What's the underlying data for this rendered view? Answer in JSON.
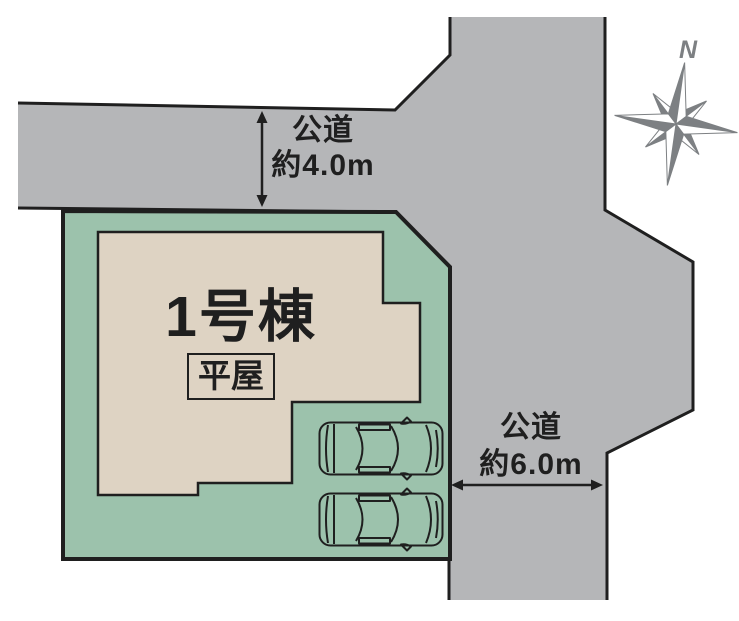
{
  "canvas": {
    "width": 739,
    "height": 621
  },
  "colors": {
    "road_fill": "#b5b6b8",
    "plot_fill": "#9cc2ac",
    "building_fill": "#ded3c3",
    "outline": "#1f1f1f",
    "compass_gray": "#7d8083",
    "compass_white": "#ffffff",
    "car_fill": "#ffffff"
  },
  "labels": {
    "building_name": "1号棟",
    "building_type": "平屋",
    "road_top_name": "公道",
    "road_top_width": "約4.0m",
    "road_right_name": "公道",
    "road_right_width": "約6.0m",
    "compass_north": "N"
  }
}
